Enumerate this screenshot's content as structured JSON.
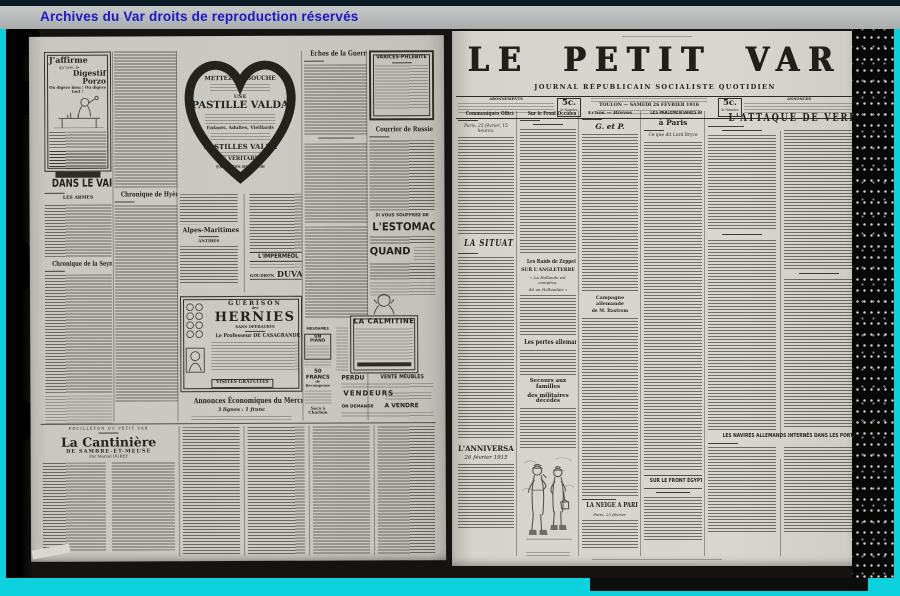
{
  "banner": {
    "text": "Archives du Var droits de reproduction réservés"
  },
  "colors": {
    "frame": "#0cd2de",
    "banner_bg": "#b6bab8",
    "banner_text": "#1a18c8",
    "paper_left": "#c9c8c0",
    "paper_right": "#d5d4cc",
    "ink": "#2b2923"
  },
  "left_page": {
    "porzo": {
      "l1": "J'affirme",
      "l2": "qu'avec le",
      "l3": "Digestif Porzo",
      "l4": "On digère bien ! On digère tout !"
    },
    "dans_le_var": "DANS LE VAR",
    "les_armes": "LES ARMES",
    "chronique_seyne": "Chronique de la Seyne",
    "chronique_hyeres": "Chronique de Hyères",
    "valda": {
      "l1": "METTEZ EN BOUCHE",
      "l2": "UNE",
      "l3": "PASTILLE VALDA",
      "l4": "Enfants, Adultes, Vieillards",
      "l5": "PASTILLES VALDA",
      "l6": "LES VÉRITABLES",
      "l7": "EN BOITES DE 1 fr. 50"
    },
    "echos_guerre": "Echos de la Guerre",
    "varices": "VARICES-PHLÉBITE",
    "courrier_russie": "Courrier de Russie",
    "alpes_maritimes": "Alpes-Maritimes",
    "antibes": "ANTIBES",
    "impermeol": "L'IMPERMÉOL",
    "goudron": "GOUDRON",
    "duval": "DUVAL",
    "estomac": {
      "l1": "SI VOUS SOUFFREZ DE",
      "l2": "L'ESTOMAC"
    },
    "quand": "QUAND",
    "hernies": {
      "l1": "GUÉRISON",
      "l2": "des",
      "l3": "HERNIES",
      "l4": "SANS OPÉRATION",
      "l5": "Le Professeur DE CASAGRANDE",
      "l6": "VISITES GRATUITES"
    },
    "calmitine": "LA CALMITINE",
    "annonces_eco": {
      "title": "Annonces Économiques du Mercredi",
      "sub": "3 lignes : 1 franc"
    },
    "classifieds": {
      "mesdames": "MESDAMES",
      "piano": "UN PIANO",
      "francs": "50 FRANCS",
      "recompense": "de Récompense",
      "sacs": "Sacs à Charbon",
      "perdu": "PERDU",
      "vente_meubles": "VENTE MEUBLES",
      "vendeurs": "VENDEURS",
      "a_vendre": "A VENDRE",
      "on_demande": "ON DEMANDE"
    },
    "feuilleton": {
      "rubric": "FEUILLETON DU PETIT VAR",
      "title": "La Cantinière",
      "sub": "DE SAMBRE-ET-MEUSE",
      "byline": "Par Marcel DUREY"
    }
  },
  "right_page": {
    "masthead": {
      "title": "LE PETIT VAR",
      "subtitle": "JOURNAL RÉPUBLICAIN SOCIALISTE QUOTIDIEN"
    },
    "infobar": {
      "abonnements": "ABONNEMENTS",
      "price": "5c.",
      "price_unit": "le Numéro",
      "dateline": "TOULON — SAMEDI 26 FÉVRIER 1916",
      "annonces": "ANNONCES"
    },
    "col1": {
      "h1": "Communiqués Officiels",
      "dateline": "Paris, 25 février, 15 heures.",
      "h2": "LA SITUATION",
      "h3": "L'ANNIVERSAIRE",
      "h3_sub": "26 février 1915"
    },
    "col2": {
      "h1": "Sur le Front Occidental",
      "h2": "Les Raids de Zeppelins",
      "h2_sub": "SUR L'ANGLETERRE",
      "h2_quote1": "« La Hollande est complice,",
      "h2_quote2": "dit un Hollandais »",
      "h3": "Les pertes allemandes",
      "h4a": "Secours aux familles",
      "h4b": "des militaires décédés"
    },
    "col3": {
      "h1": "Échos — Brèves",
      "h1_sub": "G. et P.",
      "h2a": "Campagne allemande",
      "h2b": "de M. Bastrom",
      "h3": "LA NEIGE A PARIS",
      "h3_dateline": "Paris, 25 février."
    },
    "col4": {
      "h1a": "LES PARLEMENTAIRES ANGLAIS",
      "h1b": "à Paris",
      "h1c": "Ce que dit Lord Bryce",
      "h2": "SUR LE FRONT ÉGYPTIEN"
    },
    "col56": {
      "h1": "L'ATTAQUE DE VERDUN",
      "h2": "LES NAVIRES ALLEMANDS INTERNÉS DANS LES PORTS PORTUGAIS"
    }
  }
}
